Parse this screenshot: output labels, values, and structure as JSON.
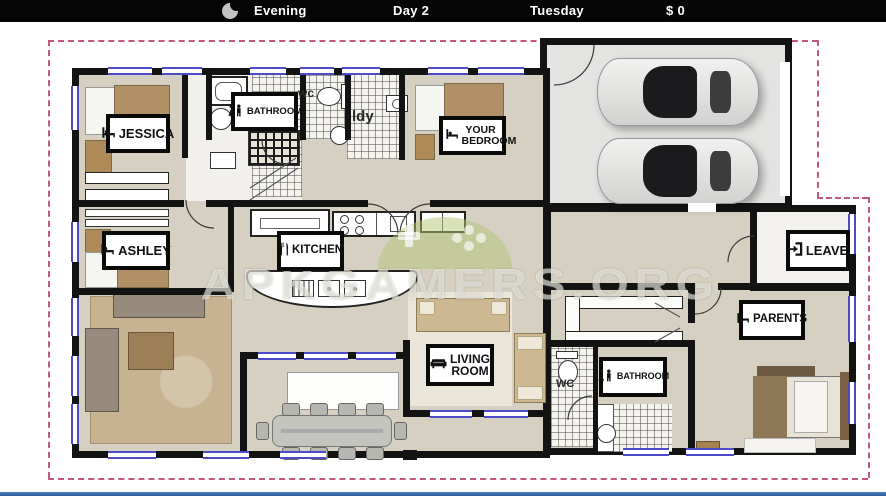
{
  "topbar": {
    "time_of_day": "Evening",
    "day": "Day 2",
    "weekday": "Tuesday",
    "money": "$ 0",
    "icon": "crescent-moon-icon"
  },
  "watermark": {
    "text": "APKGAMERS.ORG"
  },
  "labels": {
    "jessica": "JESSICA",
    "bathroom_top": "BATHROOM",
    "your_bedroom": "YOUR BEDROOM",
    "ashley": "ASHLEY",
    "kitchen": "KITCHEN",
    "leave": "LEAVE",
    "parents": "PARENTS",
    "living_room": "LIVING ROOM",
    "bathroom_bottom": "BATHROOM"
  },
  "room_texts": {
    "wc_top": "wc",
    "laundry": "ldy",
    "wc_bottom": "WC"
  },
  "colors": {
    "topbar_bg": "#050505",
    "boundary_dashed": "#c4587c",
    "floor_beige": "#d6d0c2",
    "wall_black": "#131313",
    "window_blue": "#4c4cc8",
    "watermark_green": "rgba(180,198,118,0.52)",
    "bottom_line_blue": "#3b72b0"
  }
}
